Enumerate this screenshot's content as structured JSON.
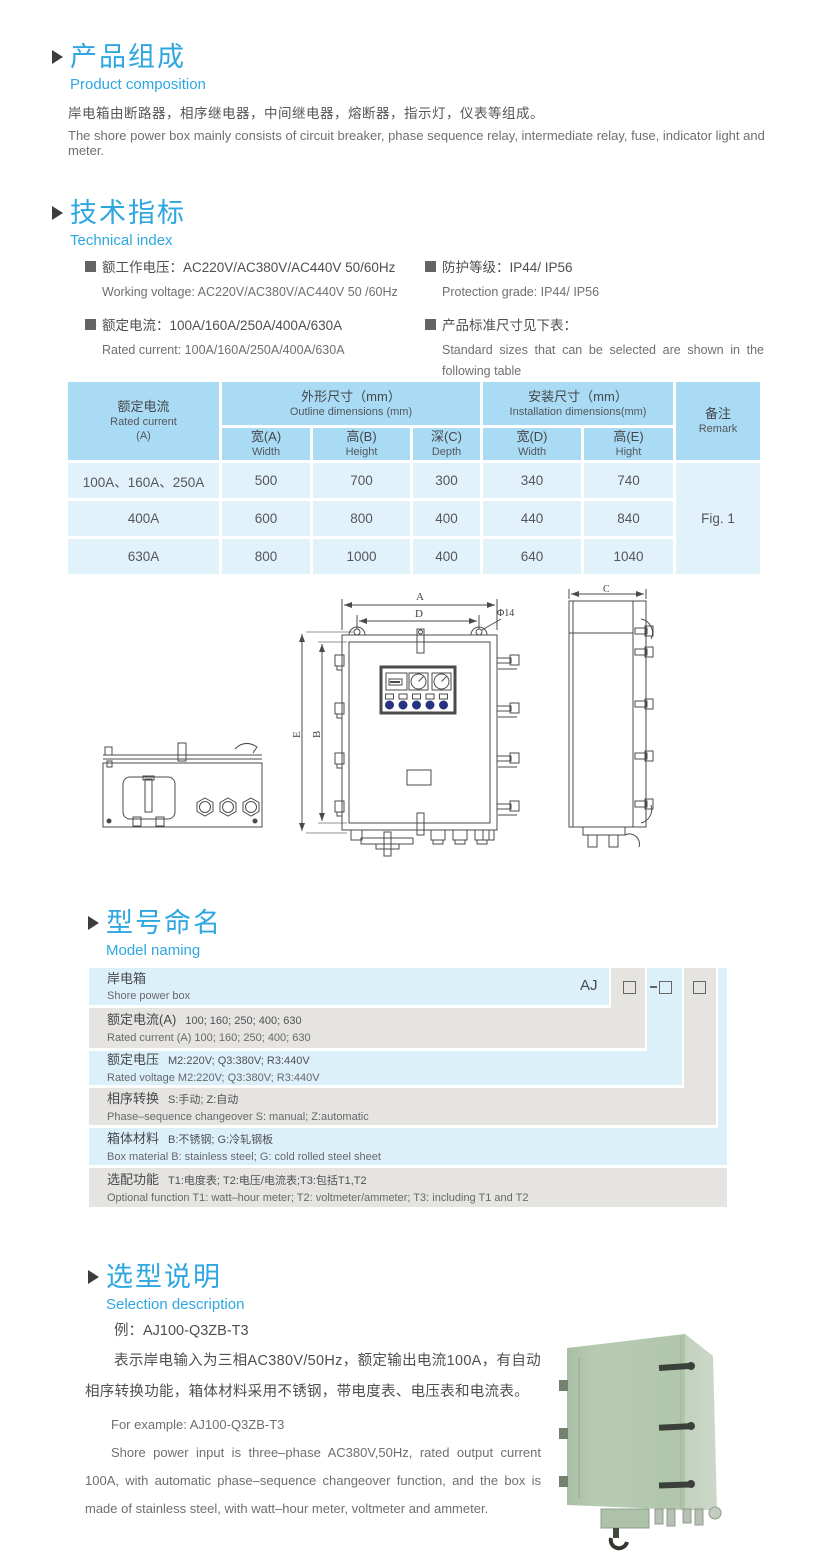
{
  "accent_color": "#2ea7e0",
  "composition": {
    "title_cn": "产品组成",
    "title_en": "Product  composition",
    "body_cn": "岸电箱由断路器，相序继电器，中间继电器，熔断器，指示灯，仪表等组成。",
    "body_en": "The shore power box mainly consists of circuit breaker, phase sequence relay, intermediate relay, fuse, indicator light and meter."
  },
  "technical": {
    "title_cn": "技术指标",
    "title_en": "Technical index",
    "specs": [
      {
        "cn": "额工作电压：AC220V/AC380V/AC440V  50/60Hz",
        "en": "Working voltage: AC220V/AC380V/AC440V 50 /60Hz"
      },
      {
        "cn": "额定电流：100A/160A/250A/400A/630A",
        "en": "Rated current: 100A/160A/250A/400A/630A"
      },
      {
        "cn": "防护等级：IP44/ IP56",
        "en": "Protection grade: IP44/ IP56"
      },
      {
        "cn": "产品标准尺寸见下表：",
        "en": "Standard sizes that can be selected are shown in the following table"
      }
    ]
  },
  "size_table": {
    "rated_cn": "额定电流",
    "rated_en": "Rated current",
    "rated_unit": "(A)",
    "outline_cn": "外形尺寸（mm）",
    "outline_en": "Outline dimensions (mm)",
    "install_cn": "安装尺寸（mm）",
    "install_en": "Installation dimensions(mm)",
    "remark_cn": "备注",
    "remark_en": "Remark",
    "sub": [
      {
        "cn": "宽(A)",
        "en": "Width"
      },
      {
        "cn": "高(B)",
        "en": "Height"
      },
      {
        "cn": "深(C)",
        "en": "Depth"
      },
      {
        "cn": "宽(D)",
        "en": "Width"
      },
      {
        "cn": "高(E)",
        "en": "Hight"
      }
    ],
    "rows": [
      {
        "rated": "100A、160A、250A",
        "v": [
          "500",
          "700",
          "300",
          "340",
          "740"
        ]
      },
      {
        "rated": "400A",
        "v": [
          "600",
          "800",
          "400",
          "440",
          "840"
        ]
      },
      {
        "rated": "630A",
        "v": [
          "800",
          "1000",
          "400",
          "640",
          "1040"
        ]
      }
    ],
    "remark_value": "Fig. 1"
  },
  "drawing": {
    "labels": {
      "A": "A",
      "D": "D",
      "dia": "Φ14",
      "E": "E",
      "B": "B",
      "C": "C"
    }
  },
  "model_naming": {
    "title_cn": "型号命名",
    "title_en": "Model naming",
    "prefix": "AJ",
    "dash": "-",
    "rows": [
      {
        "label_cn": "岸电箱",
        "en": "Shore power box"
      },
      {
        "label_cn": "额定电流(A)",
        "detail_cn": "100; 160; 250; 400; 630",
        "en": "Rated current (A) 100; 160; 250; 400; 630"
      },
      {
        "label_cn": "额定电压",
        "detail_cn": "M2:220V;  Q3:380V;  R3:440V",
        "en": "Rated voltage  M2:220V;  Q3:380V;  R3:440V"
      },
      {
        "label_cn": "相序转换",
        "detail_cn": "S:手动; Z:自动",
        "en": "Phase–sequence changeover  S: manual;  Z:automatic"
      },
      {
        "label_cn": "箱体材料",
        "detail_cn": "B:不锈钢;  G:冷轧钢板",
        "en": "Box material   B: stainless steel; G: cold rolled steel sheet"
      },
      {
        "label_cn": "选配功能",
        "detail_cn": "T1:电度表;  T2:电压/电流表;T3:包括T1,T2",
        "en": "Optional function  T1: watt–hour meter; T2: voltmeter/ammeter; T3: including T1 and T2"
      }
    ]
  },
  "selection": {
    "title_cn": "选型说明",
    "title_en": "Selection description",
    "example_cn": "例：AJ100-Q3ZB-T3",
    "body_cn": "表示岸电输入为三相AC380V/50Hz，额定输出电流100A，有自动相序转换功能，箱体材料采用不锈钢，带电度表、电压表和电流表。",
    "example_en": "For example: AJ100-Q3ZB-T3",
    "body_en": "Shore power input is three–phase AC380V,50Hz, rated output current 100A, with automatic phase–sequence changeover function, and the box is made of stainless steel, with watt–hour meter, voltmeter and ammeter."
  }
}
